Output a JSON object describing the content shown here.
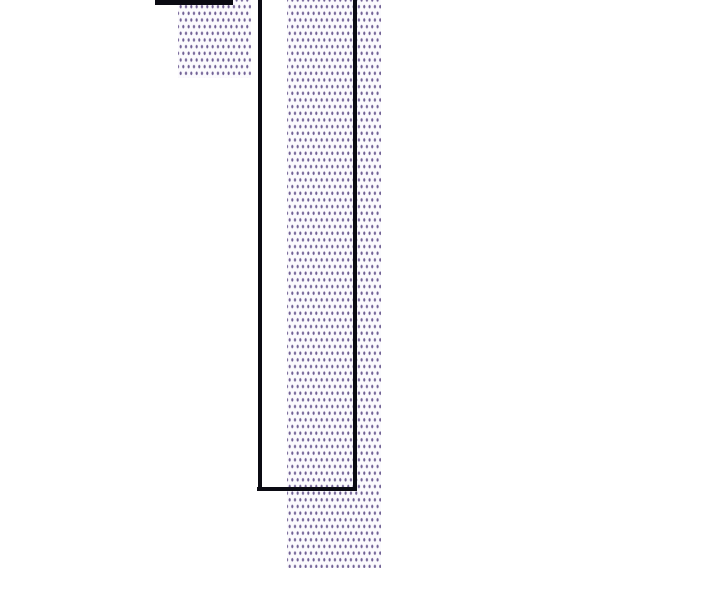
{
  "canvas": {
    "width": 720,
    "height": 600,
    "background_color": "#ffffff"
  },
  "palette": {
    "edge_color": "#0b0b13",
    "hatch_dot_core": "#6f6092",
    "hatch_dot_halo": "#aa9dc5",
    "hatch_background": "#fbfafd",
    "page_background": "#ffffff"
  },
  "chart_data": {
    "type": "bar",
    "title": "",
    "xlabel": "",
    "ylabel": "",
    "axes_visible": false,
    "tick_labels_visible": false,
    "legend_visible": false,
    "description": "Magnified crop of a bar chart: purple dot-hatched bars and black bar edges; bars run off the top edge of the frame; no text, axes or data labels are visible in the pixels",
    "hatch_pattern": {
      "style": "staggered vertical dash dots",
      "cell_width_px": 5.33,
      "cell_height_px": 13.33,
      "dash_width_px": 2.8,
      "dash_height_px": 4.8,
      "stagger_offset_px": [
        2.67,
        6.67
      ]
    },
    "visible_fragments": [
      {
        "name": "black-cap-bar",
        "style": "solid-black-fill",
        "x": 155,
        "y": 0,
        "width": 77.5,
        "height": 5
      },
      {
        "name": "small-hatched-bar",
        "style": "purple-dot-hatch",
        "x": 178,
        "y": 0,
        "width": 73,
        "height": 78
      },
      {
        "name": "outlined-bar",
        "style": "black-outline-no-fill",
        "x": 258,
        "y": 0,
        "width": 98,
        "height": 491
      },
      {
        "name": "large-hatched-bar",
        "style": "purple-dot-hatch",
        "x": 287,
        "y": 0,
        "width": 94,
        "height": 568
      }
    ]
  },
  "shapes": [
    {
      "name": "small-hatched-bar",
      "kind": "hatch",
      "x": 178,
      "y": 0,
      "w": 73,
      "h": 78
    },
    {
      "name": "large-hatched-bar",
      "kind": "hatch",
      "x": 287,
      "y": 0,
      "w": 94,
      "h": 568
    },
    {
      "name": "black-cap-bar",
      "kind": "solid",
      "x": 155,
      "y": 0,
      "w": 77.5,
      "h": 5
    },
    {
      "name": "outline-left-edge",
      "kind": "solid",
      "x": 258,
      "y": 0,
      "w": 3.5,
      "h": 491
    },
    {
      "name": "outline-right-edge",
      "kind": "solid",
      "x": 352.5,
      "y": 0,
      "w": 4,
      "h": 491
    },
    {
      "name": "outline-bottom-edge",
      "kind": "solid",
      "x": 257,
      "y": 487,
      "w": 99,
      "h": 4
    }
  ]
}
